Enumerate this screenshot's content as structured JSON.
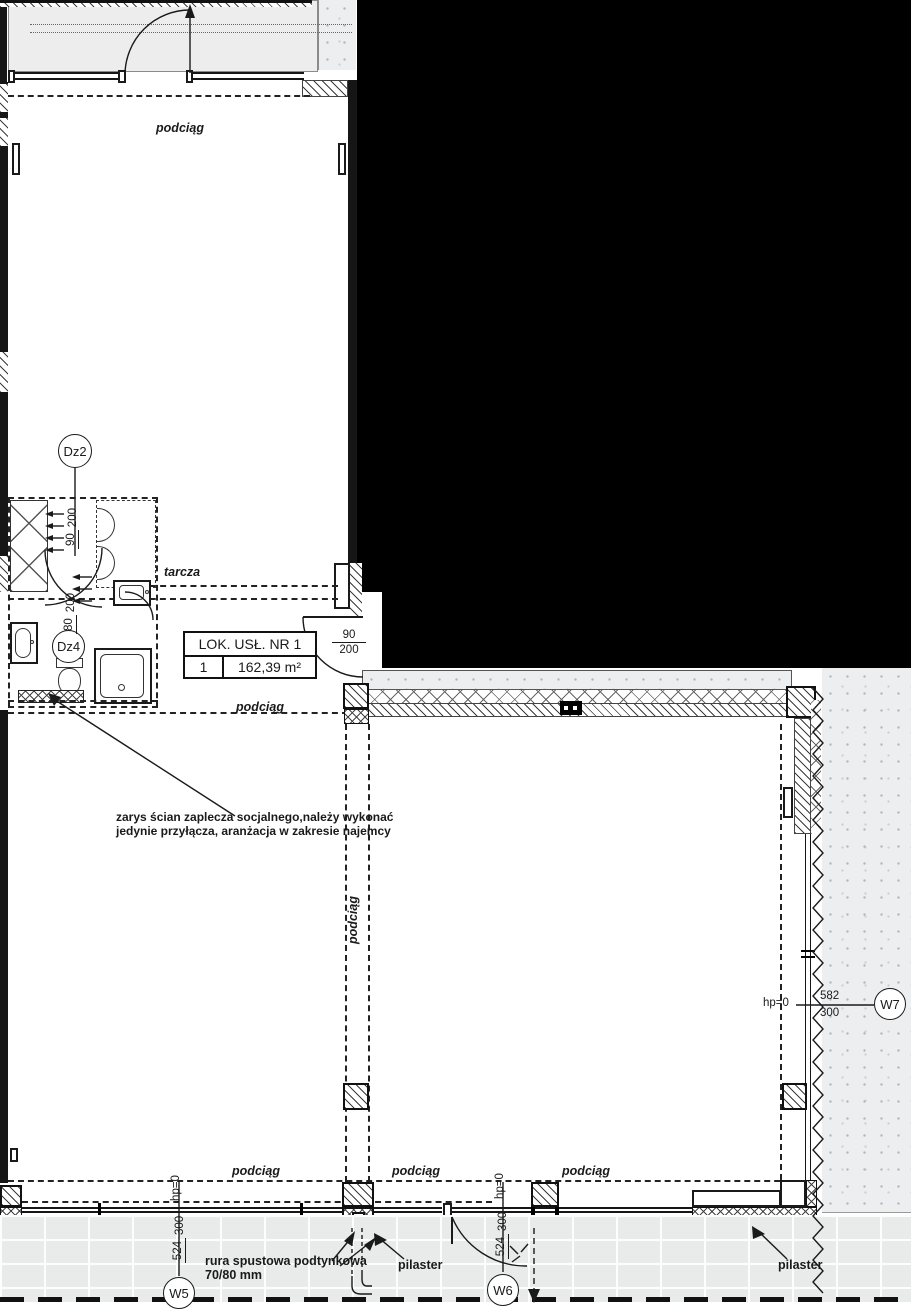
{
  "drawing": {
    "labels": {
      "podciag": "podciąg",
      "tarcza": "tarcza",
      "pilaster": "pilaster",
      "hp_zero": "hp=0",
      "note_line1": "zarys ścian zaplecza socjalnego,należy wykonać",
      "note_line2": "jedynie przyłącza, aranżacja w zakresie najemcy",
      "rura_line1": "rura spustowa podtynkowa",
      "rura_line2": "70/80 mm"
    },
    "unit_table": {
      "header": "LOK. USŁ. NR 1",
      "row_number": "1",
      "area": "162,39 m²"
    },
    "door_tags": {
      "dz2": "Dz2",
      "dz4": "Dz4"
    },
    "dimensions": {
      "door_dz2": {
        "num": "90",
        "den": "200"
      },
      "door_dz4": {
        "num": "80",
        "den": "200"
      },
      "door_middle": {
        "num": "90",
        "den": "200"
      },
      "w5": {
        "num": "524",
        "den": "300"
      },
      "w6": {
        "num": "524",
        "den": "300"
      },
      "w7": {
        "num": "582",
        "den": "300"
      }
    },
    "datum_tags": {
      "w5": "W5",
      "w6": "W6",
      "w7": "W7"
    },
    "colors": {
      "line": "#1a1a1a",
      "canopy_fill": "#ededed",
      "ground_fill": "#edeef0",
      "black_region": "#000000"
    }
  }
}
